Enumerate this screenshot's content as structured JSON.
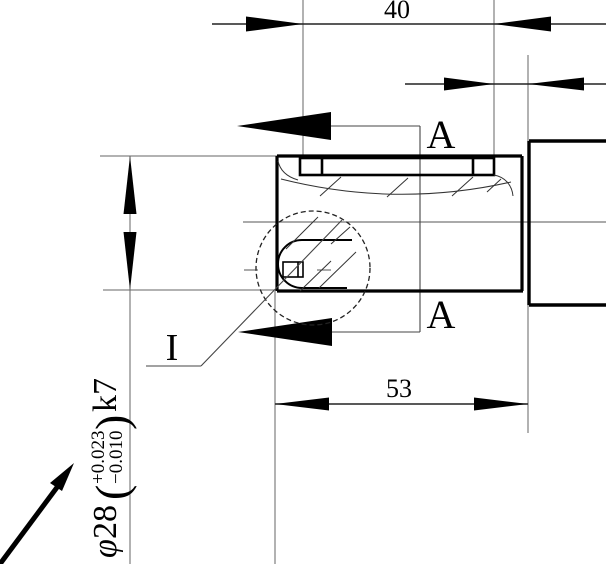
{
  "drawing": {
    "title_semantics": "shaft-keyway-detail-drawing",
    "background_color": "#ffffff",
    "outline_color": "#000000",
    "thin_line_color": "#666666",
    "dimensions": {
      "keyway_length": "40",
      "shaft_section_length": "53",
      "diameter_symbol": "φ",
      "diameter_value": "28",
      "tolerance_open_paren": "(",
      "tolerance_upper": "+0.023",
      "tolerance_lower": "−0.010",
      "tolerance_close_paren": ")",
      "fit_class": "k7"
    },
    "section_view": {
      "label_upper": "A",
      "label_lower": "A"
    },
    "detail_view": {
      "label": "I"
    }
  }
}
